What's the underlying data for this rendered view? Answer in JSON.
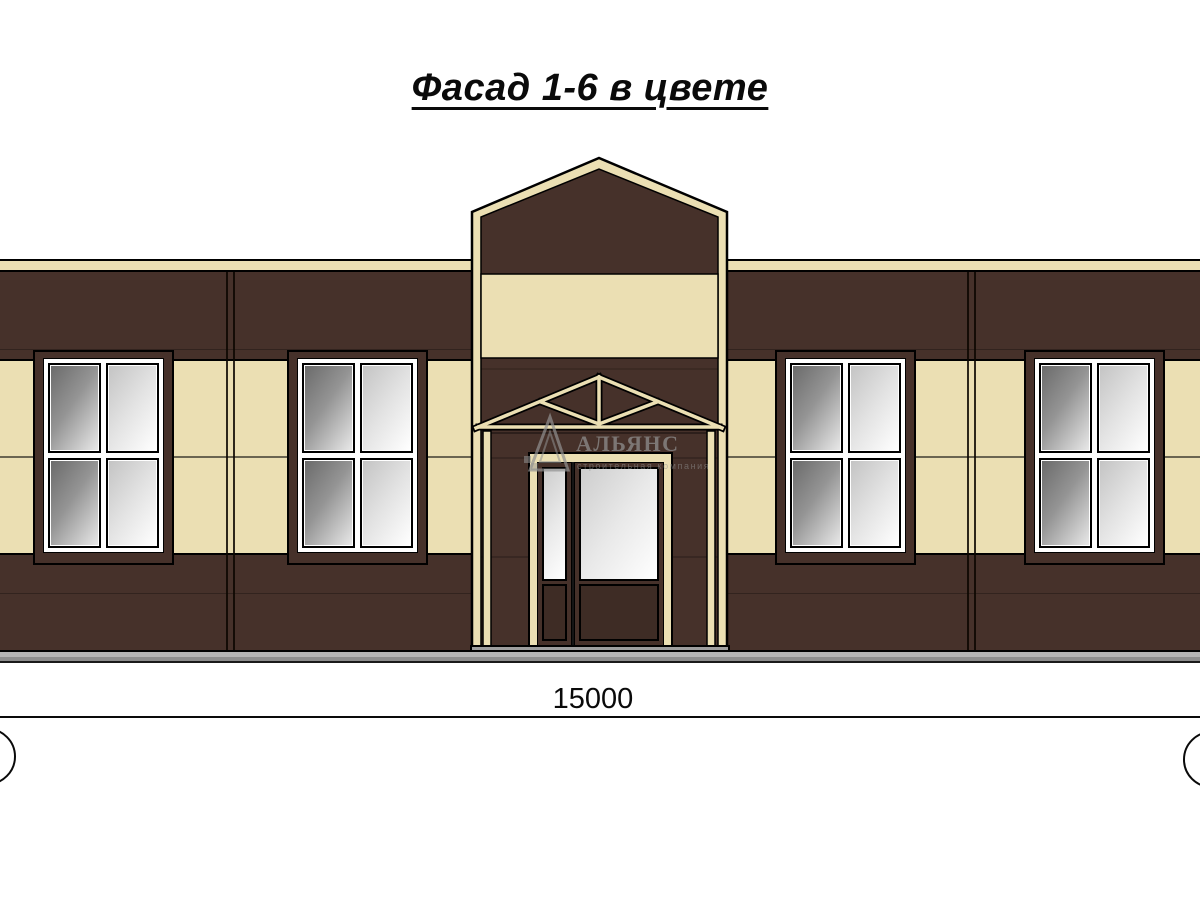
{
  "title": "Фасад 1-6 в цвете",
  "watermark": {
    "brand": "АЛЬЯНС",
    "tagline": "строительная компания"
  },
  "dimension": {
    "total_width_mm": "15000"
  },
  "colors": {
    "wall_brown": "#46312a",
    "wall_cream": "#ebdfb3",
    "outline": "#000000",
    "plinth_light": "#b4b4b4",
    "plinth_dark": "#8d8d8d",
    "watermark": "#919191"
  }
}
